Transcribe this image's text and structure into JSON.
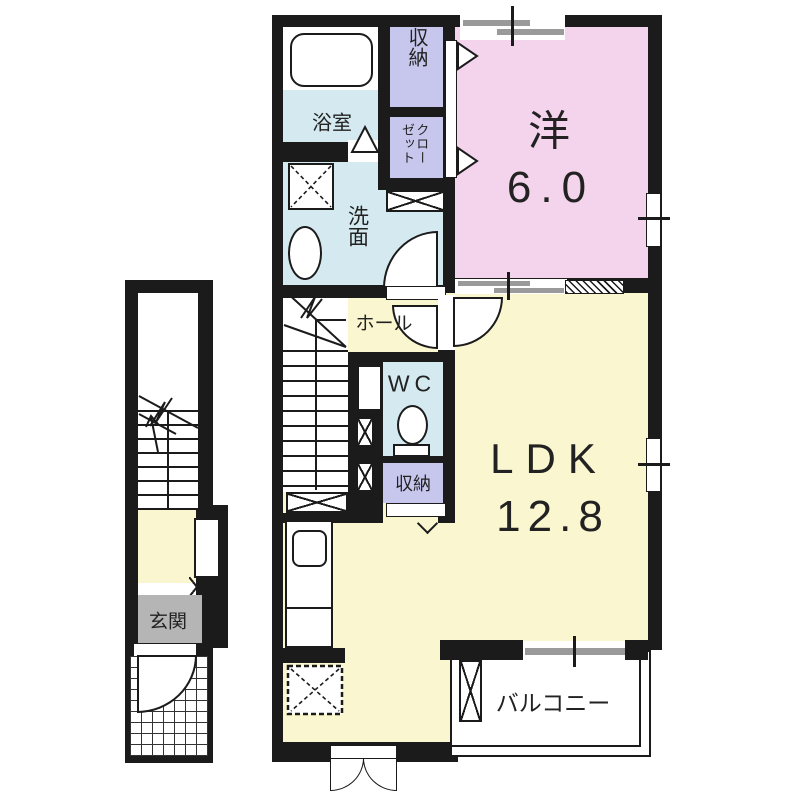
{
  "title": "apartment floor plan",
  "colors": {
    "wall": "#1b1b1b",
    "western_room": "#f4d3ec",
    "ldk": "#faf7d0",
    "wet_area": "#d4eaf0",
    "storage": "#c7c7ee",
    "entrance": "#b5b5b5",
    "window_bar": "#9a9a9a"
  },
  "rooms": {
    "bath": {
      "label": "浴室"
    },
    "storage_top": {
      "label": "収納"
    },
    "closet": {
      "label": "クローゼット"
    },
    "washroom": {
      "label": "洗面"
    },
    "western": {
      "name": "洋",
      "size": "6.0"
    },
    "hall": {
      "label": "ホール"
    },
    "wc": {
      "label": "WC"
    },
    "storage_mid": {
      "label": "収納"
    },
    "ldk": {
      "name": "LDK",
      "size": "12.8"
    },
    "balcony": {
      "label": "バルコニー"
    },
    "entrance": {
      "label": "玄関"
    }
  }
}
